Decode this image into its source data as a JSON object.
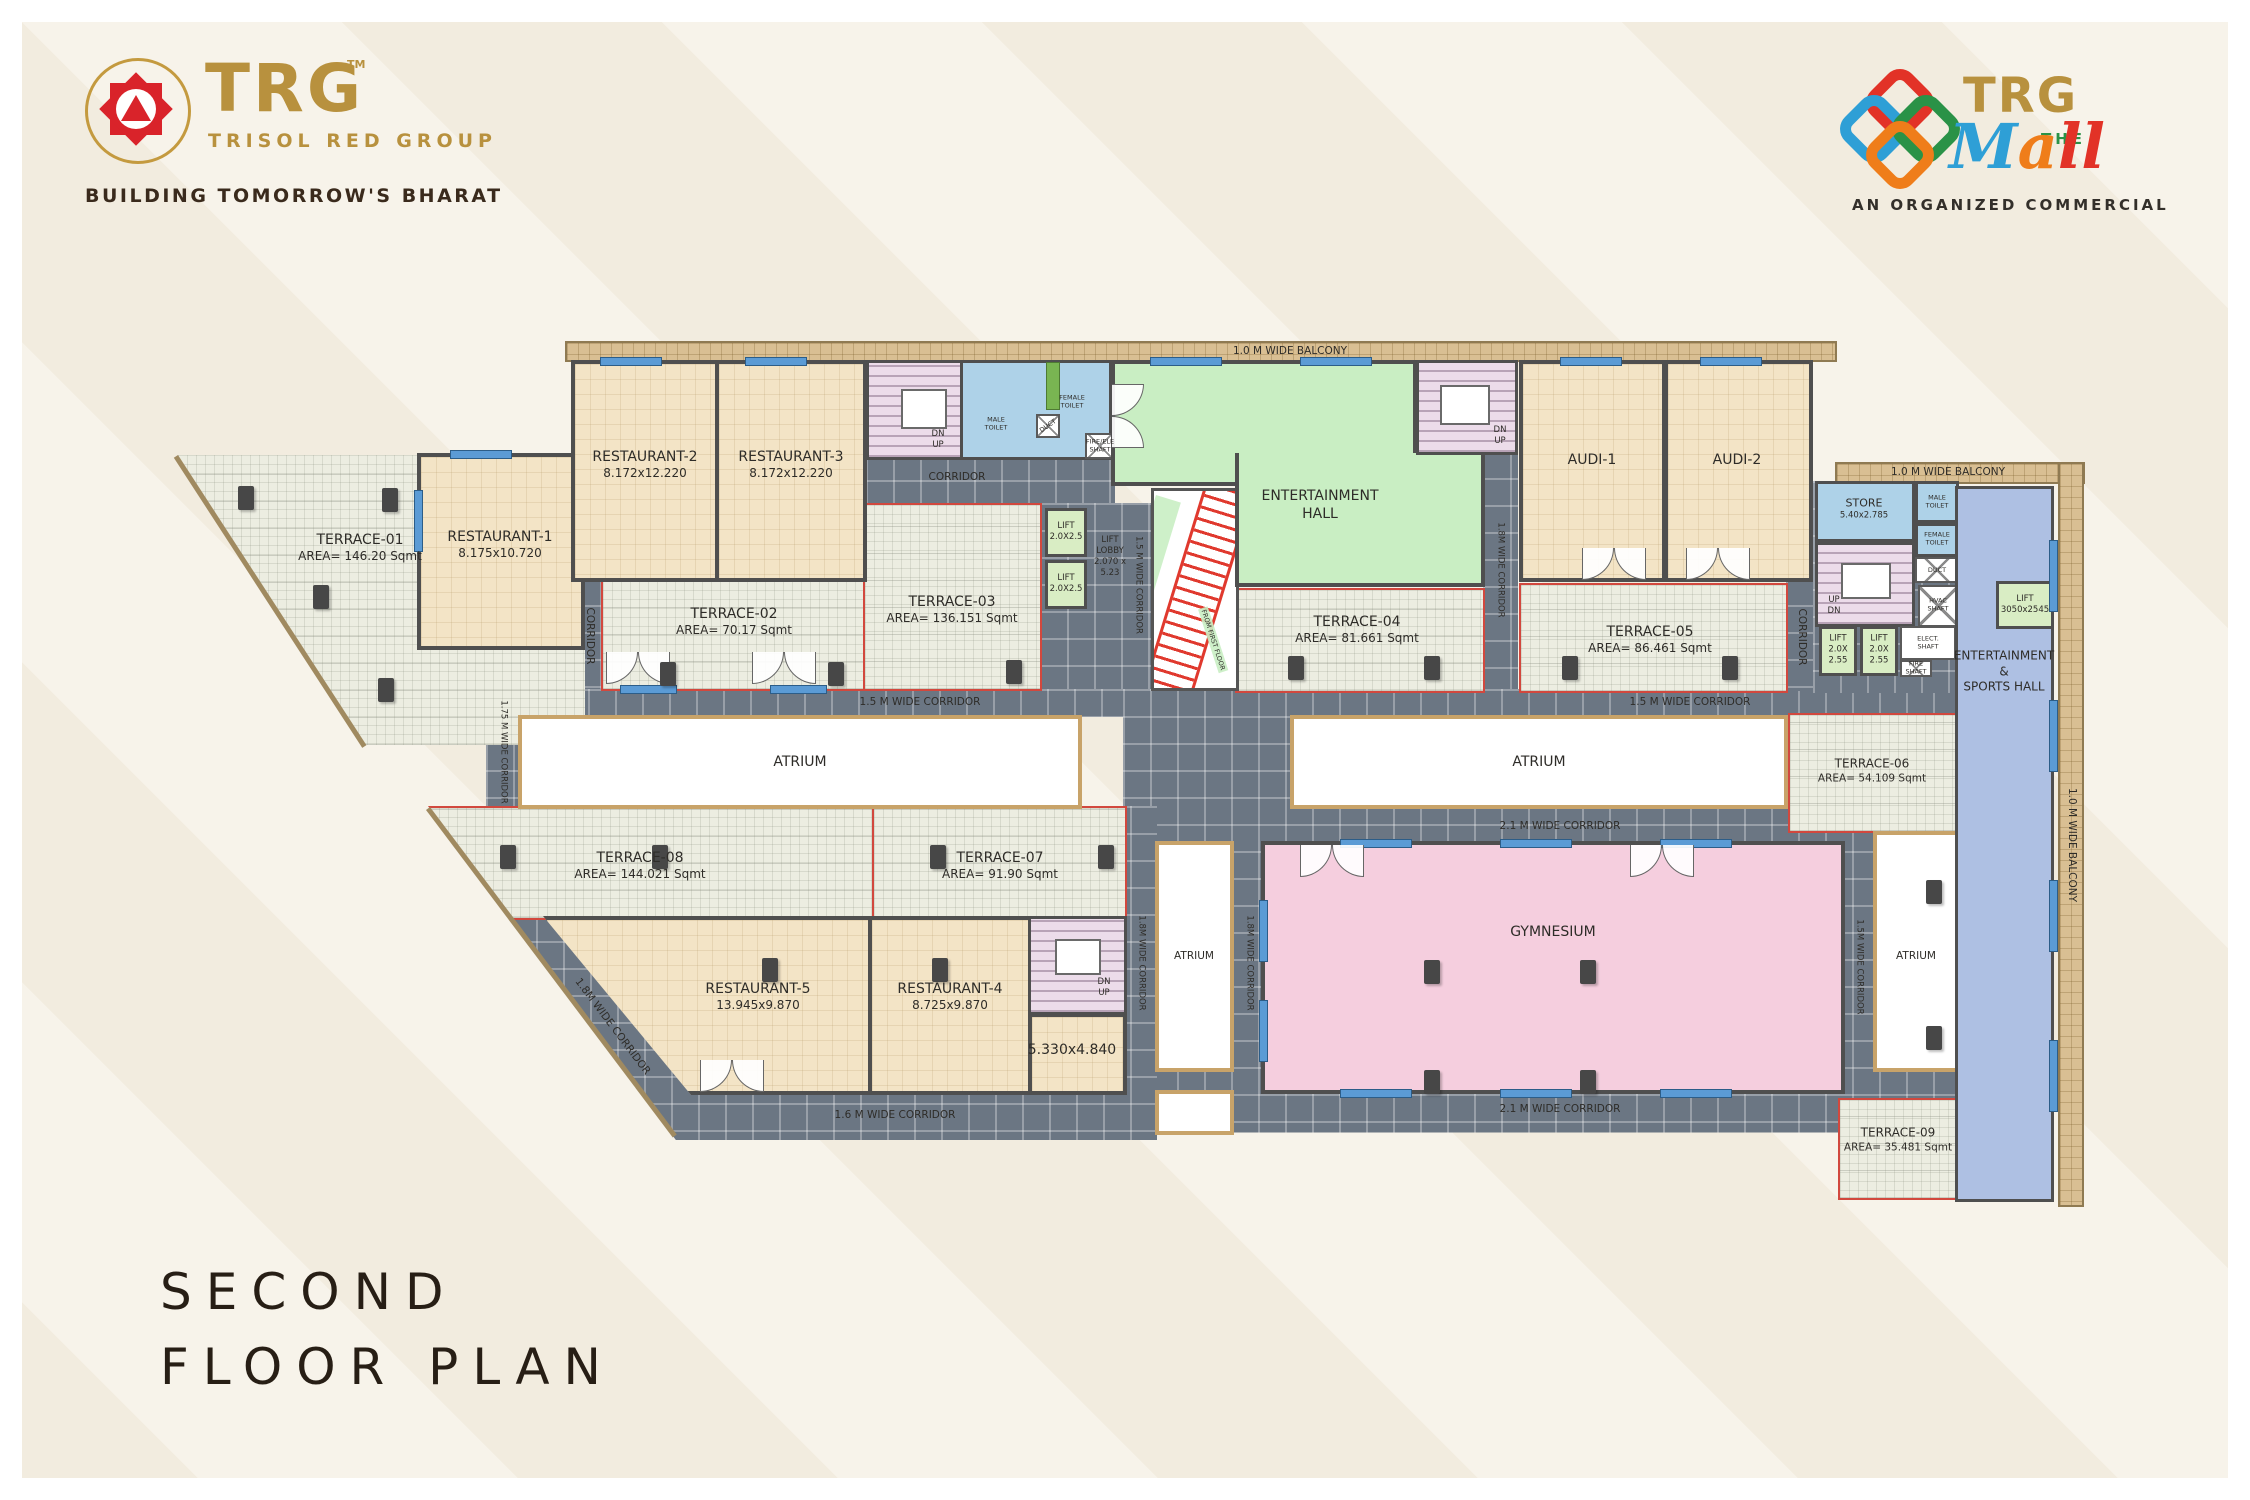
{
  "palette": {
    "canvas": "#f2ecdf",
    "corridor": "#6b7683",
    "room": "#f3e4c6",
    "terrace": "#ecede1",
    "hall": "#c9eec3",
    "gym": "#f5cede",
    "sports": "#aec0e3",
    "toilet": "#aed2e8",
    "lift": "#d9edc4",
    "stair": "#ecdcea",
    "balcony": "#d9bf93",
    "atrium_border": "#c8a369",
    "wall": "#4f4f4f",
    "red_line": "#d2483e",
    "gold": "#b8913e",
    "ink": "#271e15"
  },
  "branding": {
    "left": {
      "brand": "TRG",
      "tm": "TM",
      "subtitle": "TRISOL RED GROUP",
      "tagline": "BUILDING TOMORROW'S BHARAT"
    },
    "right": {
      "brand": "TRG",
      "the": "THE",
      "mall_m": "M",
      "mall_a": "a",
      "mall_ll": "ll",
      "tagline": "AN ORGANIZED COMMERCIAL"
    }
  },
  "title": {
    "line1": "SECOND",
    "line2": "FLOOR PLAN"
  },
  "balconies": {
    "top": "1.0  M WIDE BALCONY",
    "right_top": "1.0  M WIDE BALCONY",
    "right_side": "1.0 M WIDE BALCONY"
  },
  "corridors": {
    "top": "CORRIDOR",
    "left_vertical": "CORRIDOR",
    "right_vertical": "CORRIDOR",
    "c175": "1.75 M WIDE CORRIDOR",
    "lift_lobby_v": "1.5 M WIDE CORRIDOR",
    "c18_top": "1.8M WIDE CORRIDOR",
    "main_left": "1.5 M WIDE CORRIDOR",
    "main_right": "1.5 M WIDE CORRIDOR",
    "c21_top": "2.1 M WIDE CORRIDOR",
    "c21_bottom": "2.1 M WIDE CORRIDOR",
    "c16": "1.6 M WIDE CORRIDOR",
    "c18_diag": "1.8M WIDE CORRIDOR",
    "c18_bl_left": "1.8M WIDE CORRIDOR",
    "c18_bl_right": "1.8M WIDE CORRIDOR",
    "c15_br": "1.5M WIDE CORRIDOR"
  },
  "rooms": {
    "terrace01": {
      "name": "TERRACE-01",
      "area": "AREA= 146.20 Sqmt"
    },
    "terrace02": {
      "name": "TERRACE-02",
      "area": "AREA= 70.17   Sqmt"
    },
    "terrace03": {
      "name": "TERRACE-03",
      "area": "AREA= 136.151 Sqmt"
    },
    "terrace04": {
      "name": "TERRACE-04",
      "area": "AREA= 81.661 Sqmt"
    },
    "terrace05": {
      "name": "TERRACE-05",
      "area": "AREA= 86.461 Sqmt"
    },
    "terrace06": {
      "name": "TERRACE-06",
      "area": "AREA= 54.109  Sqmt"
    },
    "terrace07": {
      "name": "TERRACE-07",
      "area": "AREA= 91.90 Sqmt"
    },
    "terrace08": {
      "name": "TERRACE-08",
      "area": "AREA= 144.021 Sqmt"
    },
    "terrace09": {
      "name": "TERRACE-09",
      "area": "AREA= 35.481 Sqmt"
    },
    "restaurant1": {
      "name": "RESTAURANT-1",
      "dims": "8.175x10.720"
    },
    "restaurant2": {
      "name": "RESTAURANT-2",
      "dims": "8.172x12.220"
    },
    "restaurant3": {
      "name": "RESTAURANT-3",
      "dims": "8.172x12.220"
    },
    "restaurant4": {
      "name": "RESTAURANT-4",
      "dims": "8.725x9.870"
    },
    "restaurant5": {
      "name": "RESTAURANT-5",
      "dims": "13.945x9.870"
    },
    "audi1": "AUDI-1",
    "audi2": "AUDI-2",
    "hall": {
      "l1": "ENTERTAINMENT",
      "l2": "HALL"
    },
    "gym": "GYMNESIUM",
    "sports": {
      "l1": "ENTERTAINMENT",
      "l2": "&",
      "l3": "SPORTS HALL"
    },
    "store": {
      "name": "STORE",
      "dims": "5.40x2.785"
    },
    "small_room": "5.330x4.840",
    "atrium": "ATRIUM"
  },
  "facilities": {
    "lift_small": {
      "l1": "LIFT",
      "l2": "2.0X2.5"
    },
    "lift_lobby": {
      "l1": "LIFT",
      "l2": "LOBBY",
      "l3": "2.070 x",
      "l4": "5.23"
    },
    "lift_right": {
      "l1": "LIFT",
      "l2": "2.0X",
      "l3": "2.55"
    },
    "lift_big": {
      "l1": "LIFT",
      "l2": "3050x2545"
    },
    "elect_shaft": {
      "l1": "ELECT.",
      "l2": "SHAFT"
    },
    "hvac_shaft": {
      "l1": "HVAC",
      "l2": "SHAFT"
    },
    "fire_shaft": {
      "l1": "FIRE",
      "l2": "SHAFT"
    },
    "fire_ele_shaft": {
      "l1": "FIRE/ELE",
      "l2": "SHAFT"
    },
    "duct": "DUCT",
    "male_toilet": {
      "l1": "MALE",
      "l2": "TOILET"
    },
    "female_toilet": {
      "l1": "FEMALE",
      "l2": "TOILET"
    },
    "up": "UP",
    "dn": "DN",
    "escalator": "FROM FIRST FLOOR"
  }
}
